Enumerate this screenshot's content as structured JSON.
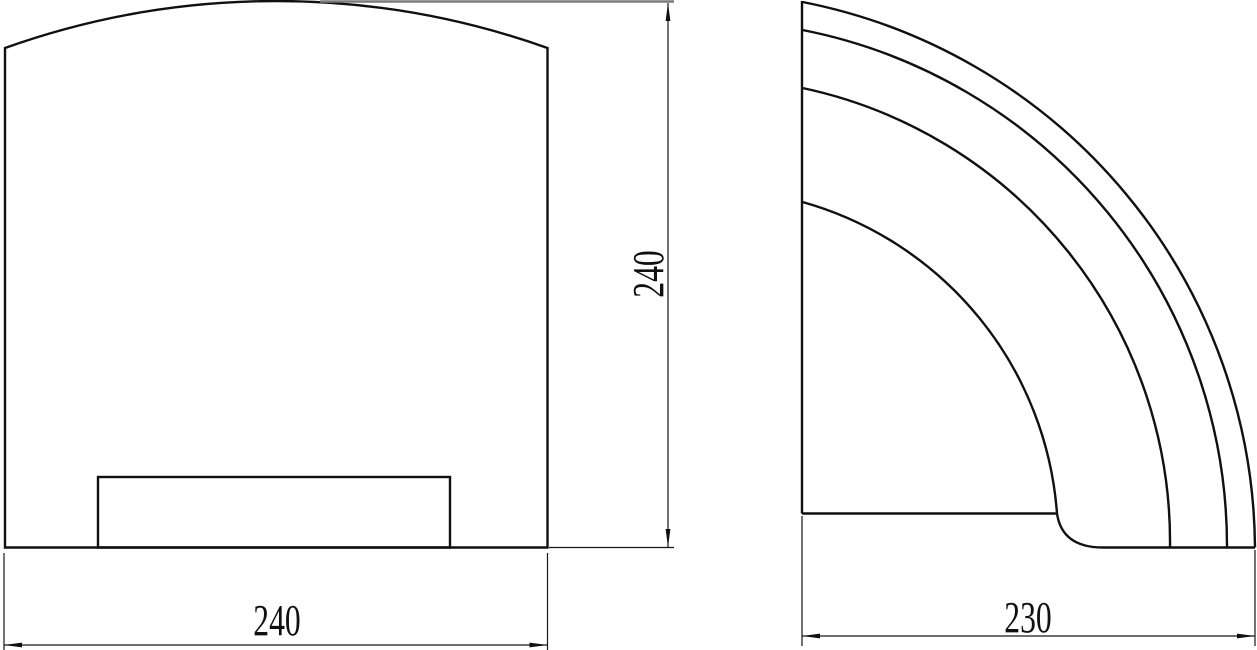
{
  "drawing": {
    "front_view": {
      "width_dimension": {
        "label": "240"
      },
      "height_dimension": {
        "label": "240"
      }
    },
    "side_view": {
      "depth_dimension": {
        "label": "230"
      }
    }
  }
}
